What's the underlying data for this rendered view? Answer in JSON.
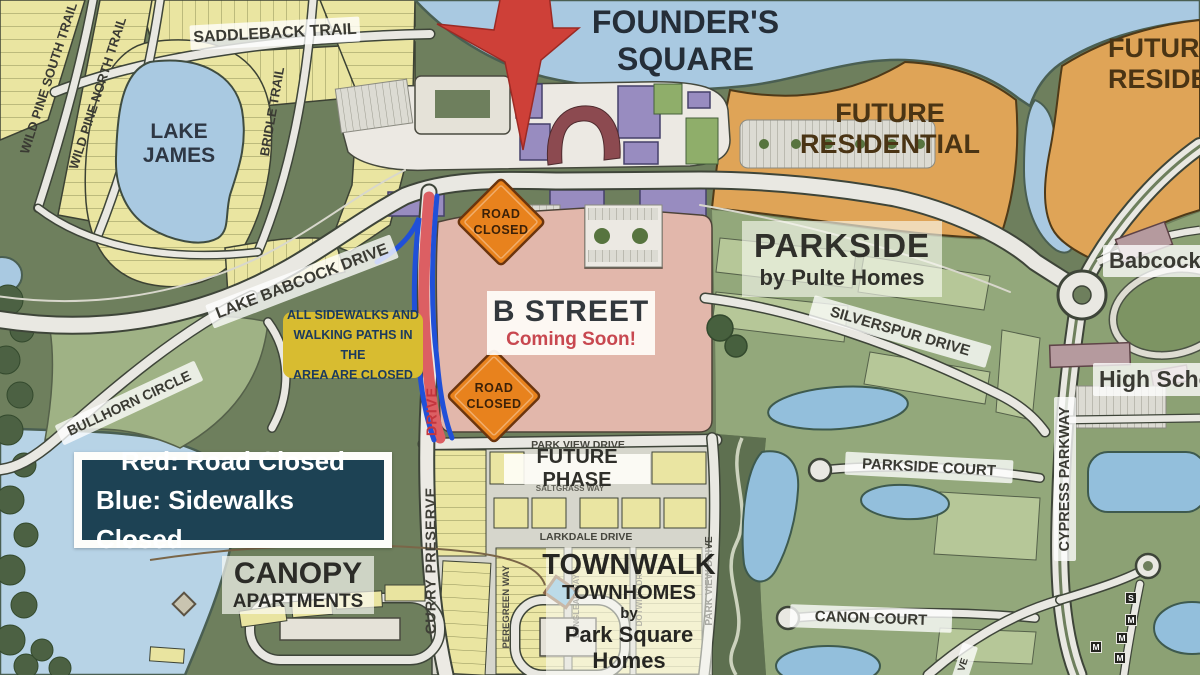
{
  "map": {
    "areas": {
      "founders_square_l1": "FOUNDER'S",
      "founders_square_l2": "SQUARE",
      "future_residential_l1": "FUTURE",
      "future_residential_l2": "RESIDENTIAL",
      "lake_james_l1": "LAKE",
      "lake_james_l2": "JAMES",
      "parkside_title": "PARKSIDE",
      "parkside_sub": "by Pulte Homes",
      "b_street_title": "B STREET",
      "b_street_sub": "Coming Soon!",
      "future_phase": "FUTURE PHASE",
      "townwalk_l1": "TOWNWALK",
      "townwalk_l2": "TOWNHOMES",
      "townwalk_l3": "by",
      "townwalk_l4": "Park Square",
      "townwalk_l5": "Homes",
      "canopy_l1": "CANOPY",
      "canopy_l2": "APARTMENTS",
      "babcock": "Babcock",
      "high_school": "High School"
    },
    "roads": {
      "saddleback": "SADDLEBACK TRAIL",
      "wild_pine_south": "WILD PINE SOUTH TRAIL",
      "wild_pine_north": "WILD PINE NORTH TRAIL",
      "bridle": "BRIDLE TRAIL",
      "lake_babcock": "LAKE BABCOCK DRIVE",
      "bullhorn": "BULLHORN CIRCLE",
      "curry_preserve": "CURRY PRESERVE",
      "curry_drive": "DRIVE",
      "park_view_h": "PARK VIEW DRIVE",
      "park_view_v": "PARK VIEW DRIVE",
      "saltgrass": "SALTGRASS WAY",
      "larkdale": "LARKDALE DRIVE",
      "peregreen": "PEREGREEN WAY",
      "longleaf": "LONGLEAF WAY",
      "dotwing": "DOTWING DR",
      "silverspur": "SILVERSPUR DRIVE",
      "parkside_court": "PARKSIDE COURT",
      "cypress": "CYPRESS PARKWAY",
      "canon": "CANON COURT",
      "drive_cut": "VE"
    },
    "annotations": {
      "note_l1": "ALL SIDEWALKS AND",
      "note_l2": "WALKING PATHS IN THE",
      "note_l3": "AREA ARE CLOSED",
      "legend_l1": "Red: Road Closed",
      "legend_l2": "Blue: Sidewalks Closed",
      "sign_l1": "ROAD",
      "sign_l2": "CLOSED"
    },
    "markers": {
      "letters": [
        "S",
        "M",
        "M",
        "M",
        "M"
      ]
    },
    "colors": {
      "closed_red": "#dc5f63",
      "sidewalk_blue": "#2050d8",
      "sign_orange": "#e8821d",
      "star_red": "#ce4038",
      "note_yellow": "#d8bc30",
      "legend_navy": "#1d4254",
      "future_orange": "#dfa457",
      "b_street_pink": "#e2b7ab",
      "water_blue": "#a9c9e1"
    }
  }
}
